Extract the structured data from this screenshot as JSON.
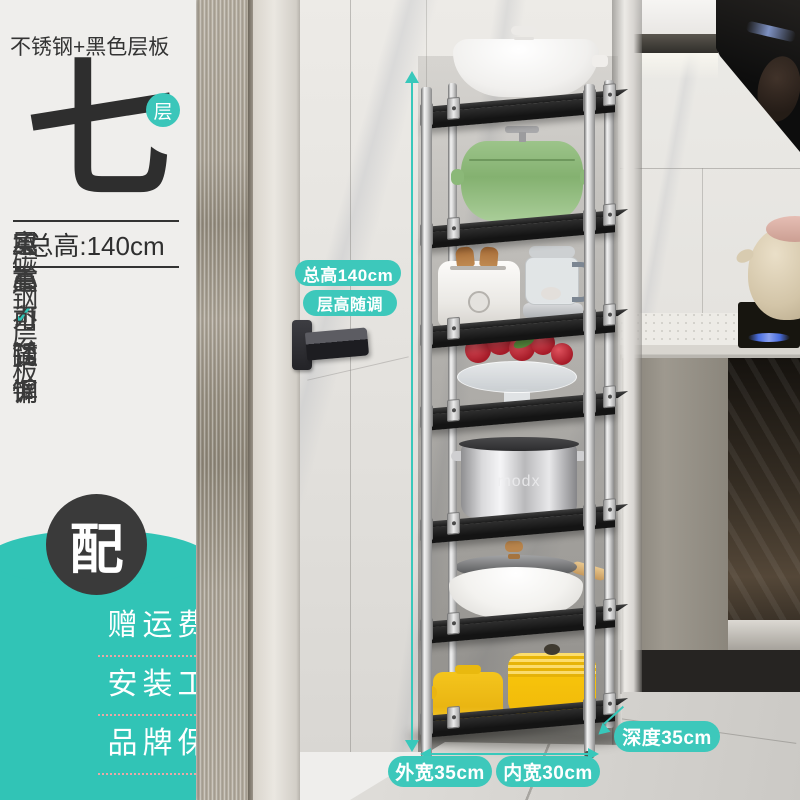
{
  "panel": {
    "material_title": "不锈钢+黑色层板",
    "tier_count_char": "七",
    "tier_badge": "层",
    "total_height_label": "总高:140cm",
    "features": [
      "实心不锈钢",
      "碳钢层板",
      "承重力强悍",
      "层高可随调"
    ],
    "gift_badge_char": "配",
    "gift_items": [
      "赠运费险",
      "安装工具",
      "品牌保证"
    ]
  },
  "annotations": {
    "total_height_pill": "总高140cm",
    "tier_adjust_pill": "层高随调",
    "outer_width_pill": "外宽35cm",
    "inner_width_pill": "内宽30cm",
    "depth_pill": "深度35cm"
  },
  "rack": {
    "tiers": 7,
    "pot_brand": "modx",
    "shelf_color": "黑色",
    "pole_material": "不锈钢"
  },
  "icons": {
    "check": "✓"
  },
  "colors": {
    "teal_accent": "#33c5b7",
    "pill_teal": "#3dc8bb",
    "dark_text": "#333333",
    "badge_dark": "#3a3a3a",
    "panel_bg": "#efeeec",
    "underline_pink": "#f5a5a5"
  }
}
